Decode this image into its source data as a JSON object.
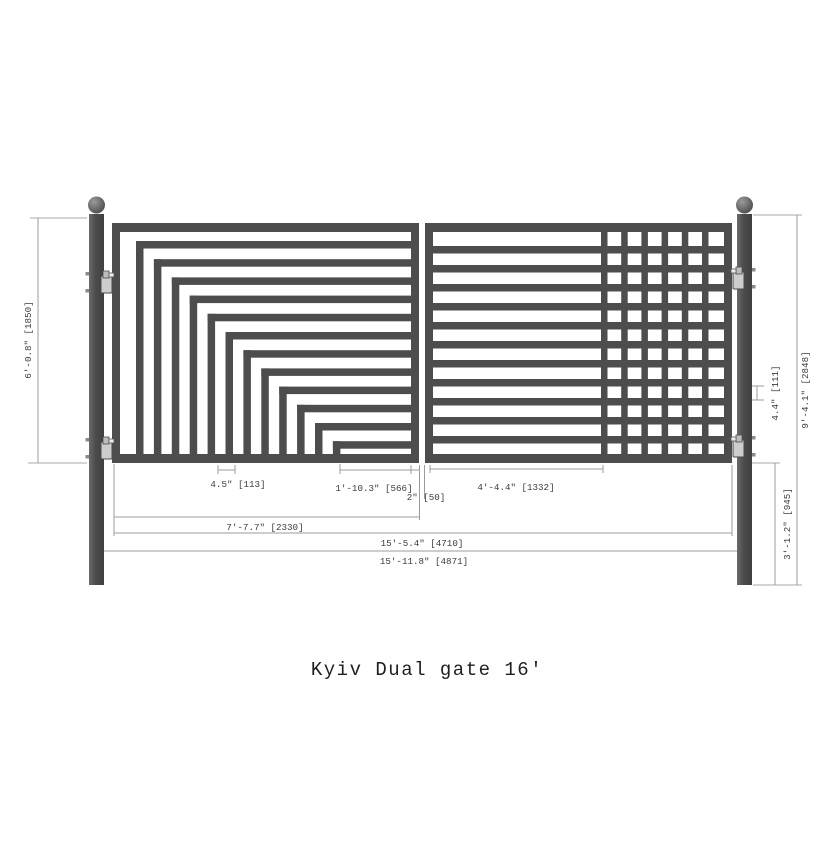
{
  "drawing": {
    "title": "Kyiv Dual gate 16'",
    "colors": {
      "steel": "#4d4d4d",
      "dim_line": "#9b9b9b",
      "dim_text": "#3c3c3c",
      "background": "#ffffff",
      "hinge_fill": "#cdcdcd"
    },
    "gate": {
      "type": "dual-swing-gate",
      "posts": 2,
      "hinges_per_post": 2,
      "left_panel": {
        "pattern": "stepped-cascade",
        "cascade_bars": 12
      },
      "right_panel": {
        "pattern": "horizontal-bars-with-grid",
        "horizontal_bars": 11,
        "grid_vertical_bars": 6
      }
    },
    "dimensions": {
      "gate_height": "6'-0.8\" [1850]",
      "picket_spacing": "4.5\" [113]",
      "left_panel_opening": "1'-10.3\" [566]",
      "panel_gap": "2\" [50]",
      "right_panel_section": "4'-4.4\" [1332]",
      "left_panel_width": "7'-7.7\" [2330]",
      "gates_width": "15'-5.4\" [4710]",
      "overall_width": "15'-11.8\" [4871]",
      "bar_spacing": "4.4\" [111]",
      "below_gate_height": "3'-1.2\" [945]",
      "post_height": "9'-4.1\" [2848]"
    }
  }
}
